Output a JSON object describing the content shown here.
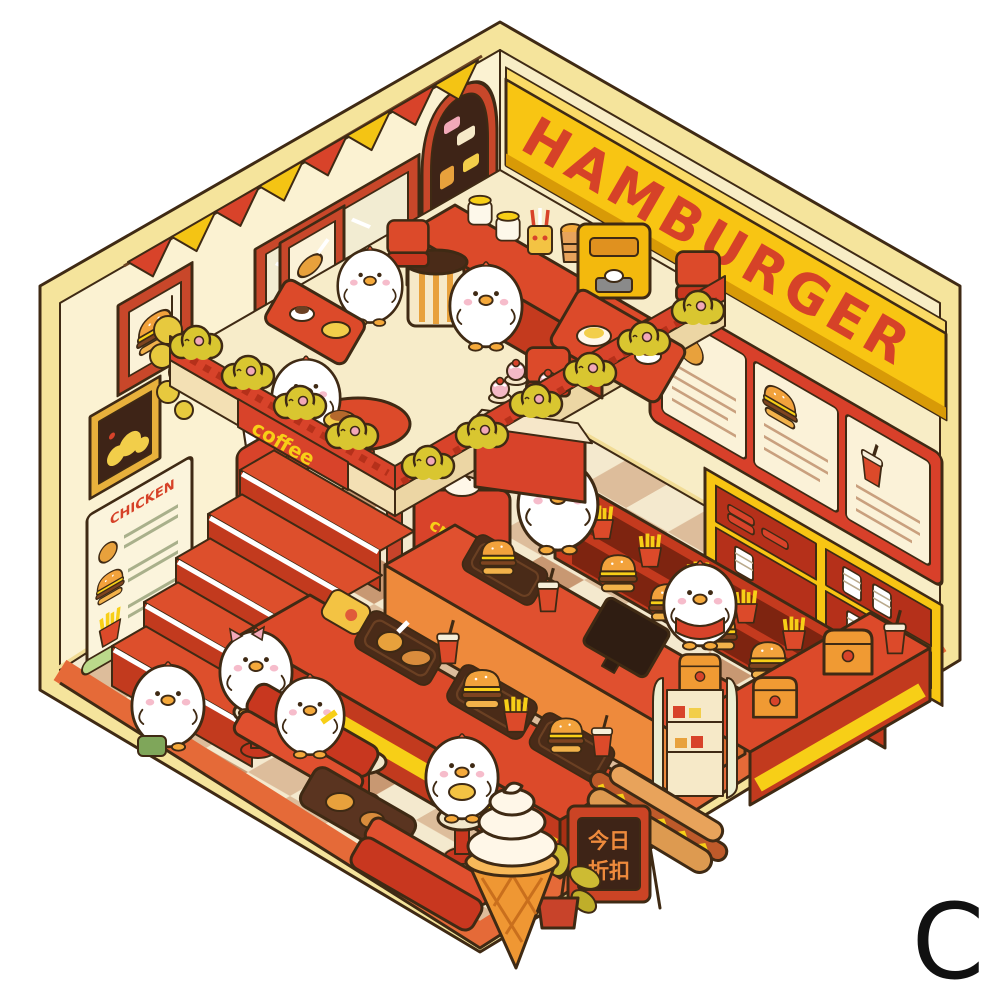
{
  "scene": {
    "background": "#ffffff",
    "variant_letter": "C"
  },
  "signboard": {
    "text": "HAMBURGER",
    "band_color": "#F8C513",
    "letter_color": "#D64228"
  },
  "balcony": {
    "coffee_label": "coffee",
    "label_color": "#F7CF17"
  },
  "soft_serve_machine": {
    "cream_label": "cream",
    "label_color": "#F7CF17"
  },
  "wall_poster": {
    "title": "CHICKEN",
    "title_color": "#D64228"
  },
  "discount_board": {
    "line1": "今日",
    "line2": "折扣",
    "text_color": "#EE8A3C"
  },
  "palette": {
    "outline": "#3F2A14",
    "wall_cream": "#FBF2D2",
    "rim_yellow": "#F5E49C",
    "red": "#DC4A2A",
    "dark_red": "#C23A1E",
    "yellow": "#F7CF17",
    "orange": "#EE8A3C",
    "floor_tan": "#DDBD9B",
    "floor_cream": "#F4E9CE",
    "floor_border": "#E56A38",
    "foliage": "#D9C630",
    "heart_pink": "#F2A8B8",
    "duck_white": "#FFFFFF"
  }
}
